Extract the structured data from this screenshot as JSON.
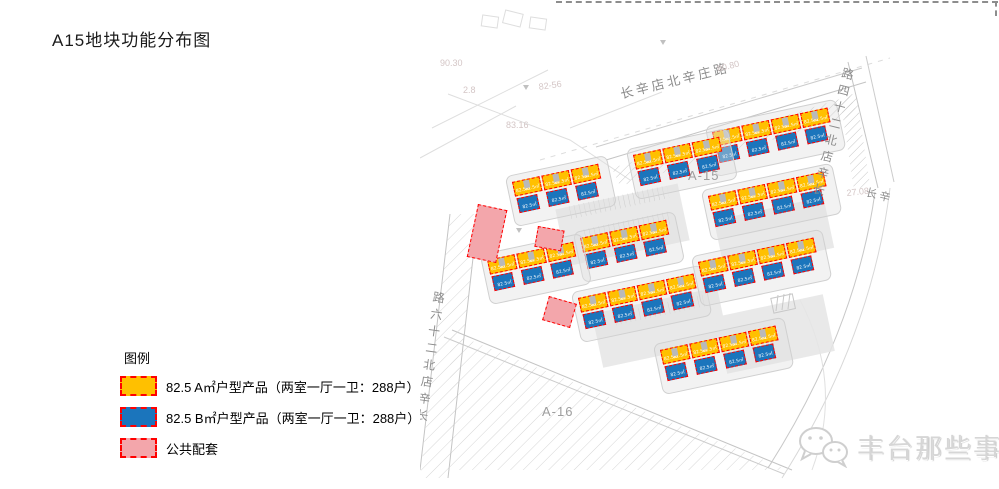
{
  "page": {
    "title": "A15地块功能分布图"
  },
  "legend": {
    "header": "图例",
    "items": [
      {
        "key": "type-a",
        "label": "82.5 A㎡户型产品（两室一厅一卫：288户）",
        "fill": "#FFC000",
        "border": "#FF0000"
      },
      {
        "key": "type-b",
        "label": "82.5 B㎡户型产品（两室一厅一卫：288户）",
        "fill": "#1B75BC",
        "border": "#FF0000"
      },
      {
        "key": "public",
        "label": "公共配套",
        "fill": "#F3A6AB",
        "border": "#FF0000"
      }
    ]
  },
  "map": {
    "unit_label": "82.5㎡",
    "colors": {
      "type_a": "#FFC000",
      "type_b": "#1B75BC",
      "public": "#F3A6AB",
      "outline": "#FF0000",
      "road_text": "#8C8C8C"
    },
    "plot_labels": [
      {
        "text": "A-15",
        "x": 268,
        "y": 168
      },
      {
        "text": "A-16",
        "x": 122,
        "y": 404
      }
    ],
    "road_labels": [
      {
        "text": "长辛店北辛庄路",
        "x": 198,
        "y": 84,
        "rot": -14,
        "vertical": false,
        "size": 13
      },
      {
        "text": "长辛店北二十四路",
        "x": 424,
        "y": 64,
        "rot": 14,
        "vertical": true,
        "size": 12
      },
      {
        "text": "长辛店北二十六路",
        "x": 14,
        "y": 288,
        "rot": 8,
        "vertical": true,
        "size": 12
      },
      {
        "text": "长辛",
        "x": 448,
        "y": 184,
        "rot": 14,
        "vertical": false,
        "size": 11
      }
    ],
    "elevation_labels": [
      {
        "text": "90.30",
        "x": 20,
        "y": 58,
        "rot": 0
      },
      {
        "text": "2.8",
        "x": 43,
        "y": 85,
        "rot": 0
      },
      {
        "text": "82-56",
        "x": 118,
        "y": 82,
        "rot": -8
      },
      {
        "text": "83.16",
        "x": 86,
        "y": 120,
        "rot": 0
      },
      {
        "text": "80.80",
        "x": 296,
        "y": 64,
        "rot": -14
      },
      {
        "text": "27.08",
        "x": 426,
        "y": 188,
        "rot": -6
      }
    ],
    "building_rows": [
      {
        "x": 292,
        "y": 132,
        "count": 4,
        "rot": -12
      },
      {
        "x": 213,
        "y": 155,
        "count": 3,
        "rot": -12
      },
      {
        "x": 92,
        "y": 182,
        "count": 3,
        "rot": -12
      },
      {
        "x": 288,
        "y": 196,
        "count": 4,
        "rot": -12
      },
      {
        "x": 160,
        "y": 238,
        "count": 3,
        "rot": -12
      },
      {
        "x": 67,
        "y": 260,
        "count": 3,
        "rot": -12
      },
      {
        "x": 158,
        "y": 298,
        "count": 4,
        "rot": -12
      },
      {
        "x": 278,
        "y": 262,
        "count": 4,
        "rot": -12
      },
      {
        "x": 240,
        "y": 350,
        "count": 4,
        "rot": -12
      }
    ],
    "public_blocks": [
      {
        "x": 58,
        "y": 204,
        "w": 30,
        "h": 54,
        "rot": 12
      },
      {
        "x": 118,
        "y": 226,
        "w": 27,
        "h": 21,
        "rot": 10
      },
      {
        "x": 129,
        "y": 296,
        "w": 29,
        "h": 25,
        "rot": 16
      }
    ]
  },
  "watermark": {
    "text": "丰台那些事",
    "icon": "wechat-logo-icon"
  }
}
